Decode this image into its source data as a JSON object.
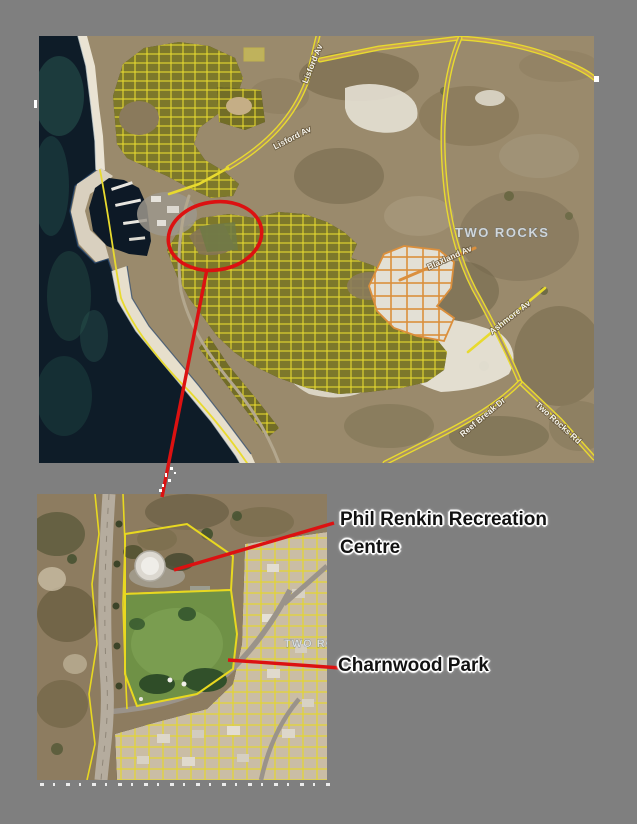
{
  "figure": {
    "description": "Aerial locality plan of Two Rocks with zoom inset identifying community facilities",
    "background_color": "#7f7f7f"
  },
  "main_map": {
    "place_label": "TWO ROCKS",
    "road_labels": {
      "lisford_lower": "Lisford Av",
      "lisford_upper": "Lisford Av",
      "blaxland": "Blaxland Av",
      "ashmore": "Ashmore Av",
      "reef_break": "Reef Break Dr",
      "two_rocks_road": "Two Rocks Rd"
    }
  },
  "inset_map": {
    "place_label_partial": "TWO RO"
  },
  "annotations": {
    "recreation_centre_line1": "Phil Renkin Recreation",
    "recreation_centre_line2": "Centre",
    "park": "Charnwood Park"
  },
  "colors": {
    "background": "#7f7f7f",
    "highlight_red": "#dc1111",
    "cadastre_yellow": "#e8da2e",
    "new_subdivision_orange": "#db8f3c",
    "ocean": "#0e1c28",
    "park_green": "#6f9146",
    "annotation_text": "#121212",
    "annotation_halo": "#ffffff"
  }
}
